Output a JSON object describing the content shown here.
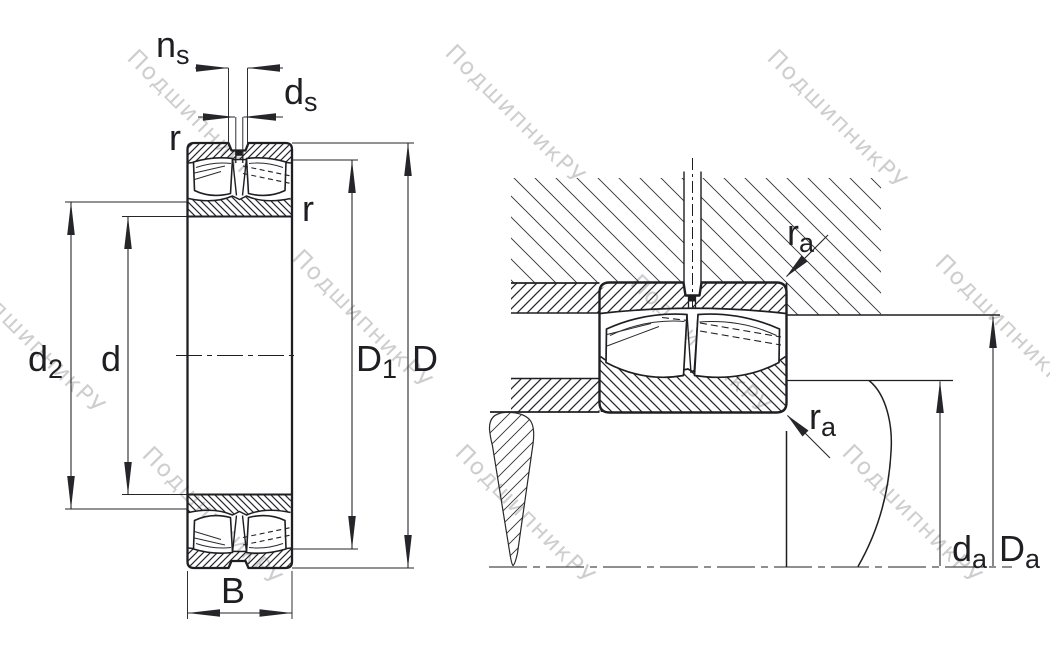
{
  "background_color": "#ffffff",
  "line_color": "#1f1f23",
  "dimension_color": "#26262a",
  "watermark": {
    "text": "ПодшипникРУ",
    "color": "#c6c6c6"
  },
  "left_view": {
    "labels": {
      "ns": {
        "base": "n",
        "sub": "s"
      },
      "ds": {
        "base": "d",
        "sub": "s"
      },
      "r_top": "r",
      "r_side": "r",
      "d2": {
        "base": "d",
        "sub": "2"
      },
      "d": "d",
      "D1": {
        "base": "D",
        "sub": "1"
      },
      "D": "D",
      "B": "B"
    }
  },
  "right_view": {
    "labels": {
      "ra_top": {
        "base": "r",
        "sub": "a"
      },
      "ra_bottom": {
        "base": "r",
        "sub": "a"
      },
      "da": {
        "base": "d",
        "sub": "a"
      },
      "Da": {
        "base": "D",
        "sub": "a"
      }
    }
  }
}
